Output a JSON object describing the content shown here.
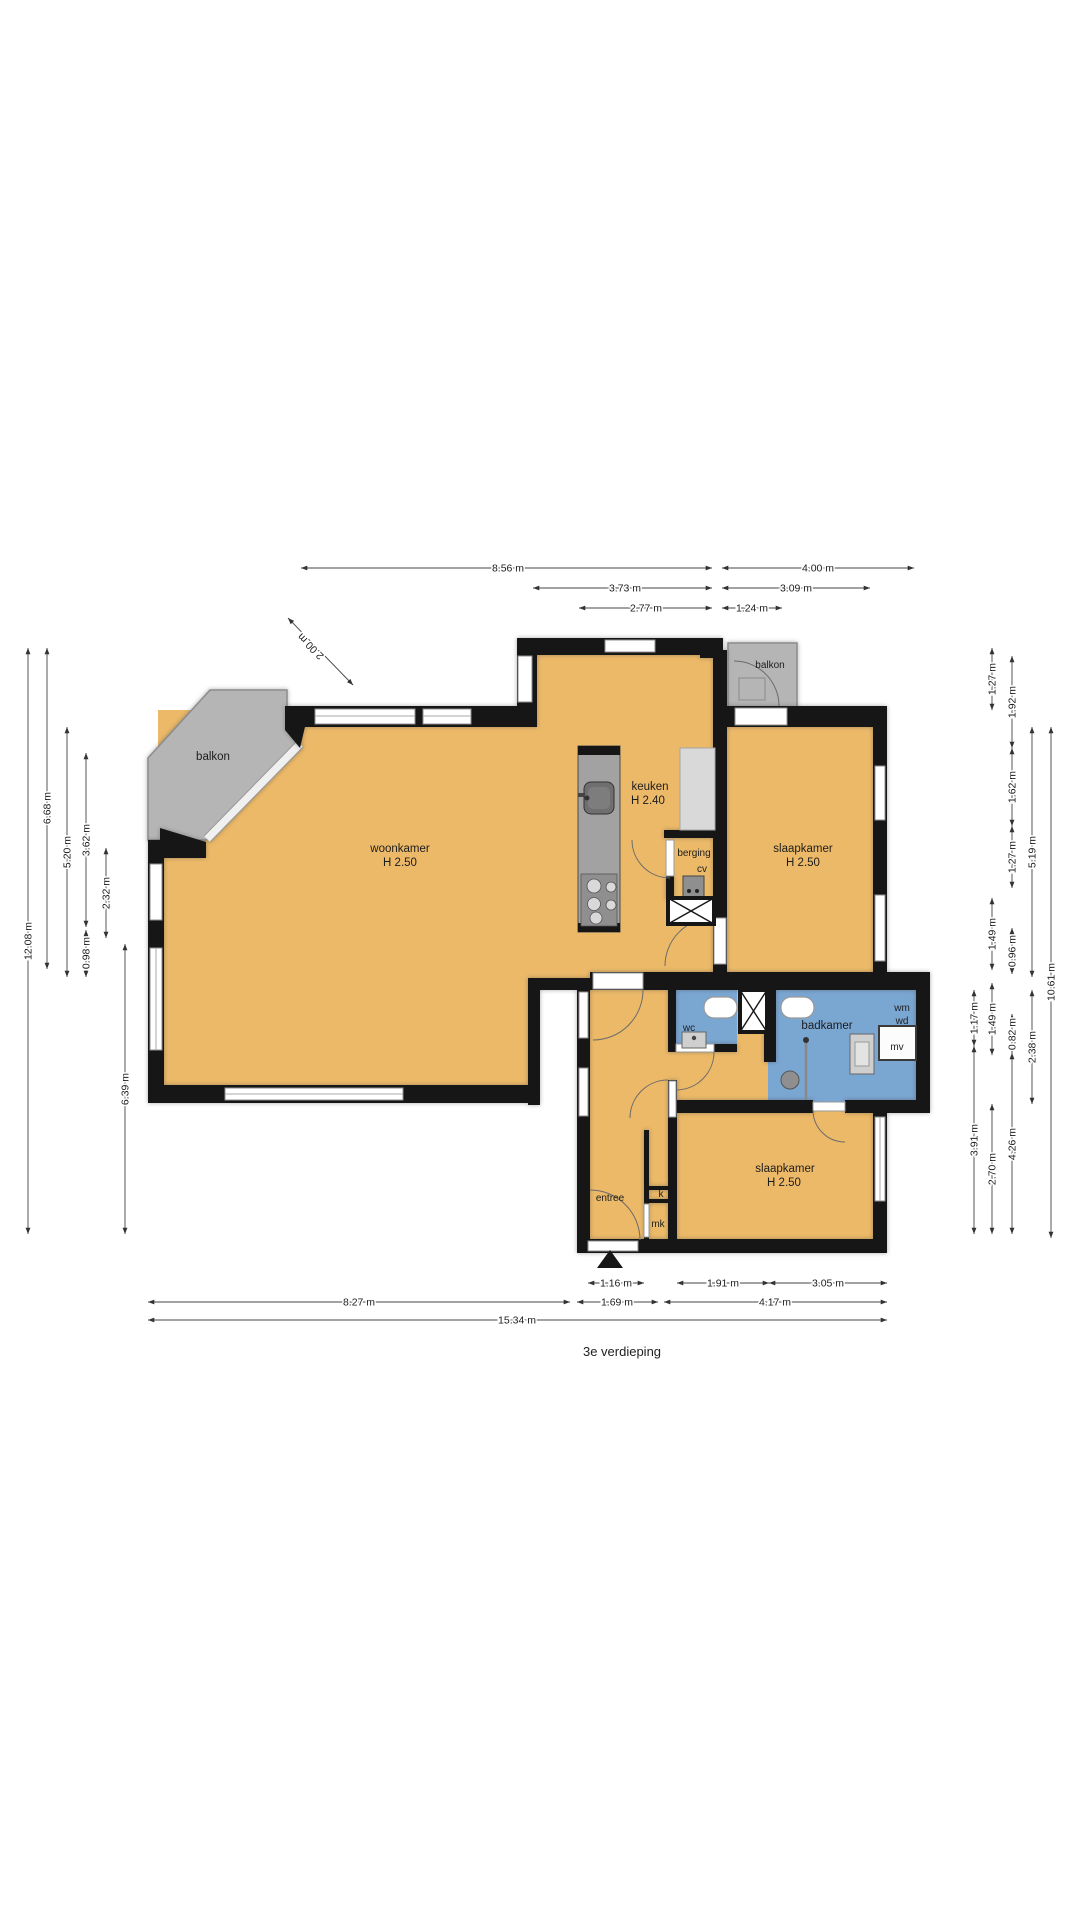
{
  "title": "3e verdieping",
  "rooms": {
    "balkon_left": {
      "label": "balkon"
    },
    "woonkamer": {
      "label": "woonkamer",
      "ceiling": "H 2.50"
    },
    "keuken": {
      "label": "keuken",
      "ceiling": "H 2.40"
    },
    "berging": {
      "label": "berging"
    },
    "cv": {
      "label": "cv"
    },
    "balkon_right": {
      "label": "balkon"
    },
    "slaapkamer_1": {
      "label": "slaapkamer",
      "ceiling": "H 2.50"
    },
    "wc": {
      "label": "wc"
    },
    "badkamer": {
      "label": "badkamer"
    },
    "wasmachine": {
      "label": "wm"
    },
    "wasdroger": {
      "label": "wd"
    },
    "mech_ventilatie": {
      "label": "mv"
    },
    "slaapkamer_2": {
      "label": "slaapkamer",
      "ceiling": "H 2.50"
    },
    "entree": {
      "label": "entree"
    },
    "kast": {
      "label": "k"
    },
    "meterkast": {
      "label": "mk"
    }
  },
  "dimensions": {
    "top": [
      "8.56 m",
      "4.00 m",
      "3.73 m",
      "3.09 m",
      "2.77 m",
      "1.24 m"
    ],
    "diagonal": "2.00 m",
    "left": [
      "12.08 m",
      "6.68 m",
      "5.20 m",
      "3.62 m",
      "0.98 m",
      "2.32 m",
      "6.39 m"
    ],
    "right": [
      "1.27 m",
      "1.92 m",
      "1.62 m",
      "1.27 m",
      "5.19 m",
      "10.61 m",
      "1.49 m",
      "0.96 m",
      "1.17 m",
      "0.82 m",
      "1.49 m",
      "2.38 m",
      "3.91 m",
      "4.26 m",
      "2.70 m"
    ],
    "bottom": [
      "1.16 m",
      "1.91 m",
      "3.05 m",
      "8.27 m",
      "1.69 m",
      "4.17 m",
      "15.34 m"
    ]
  },
  "colors": {
    "floor": "#ecb968",
    "wet_room": "#7aa6d2",
    "balcony": "#b5b5b5",
    "wall": "#161616"
  }
}
